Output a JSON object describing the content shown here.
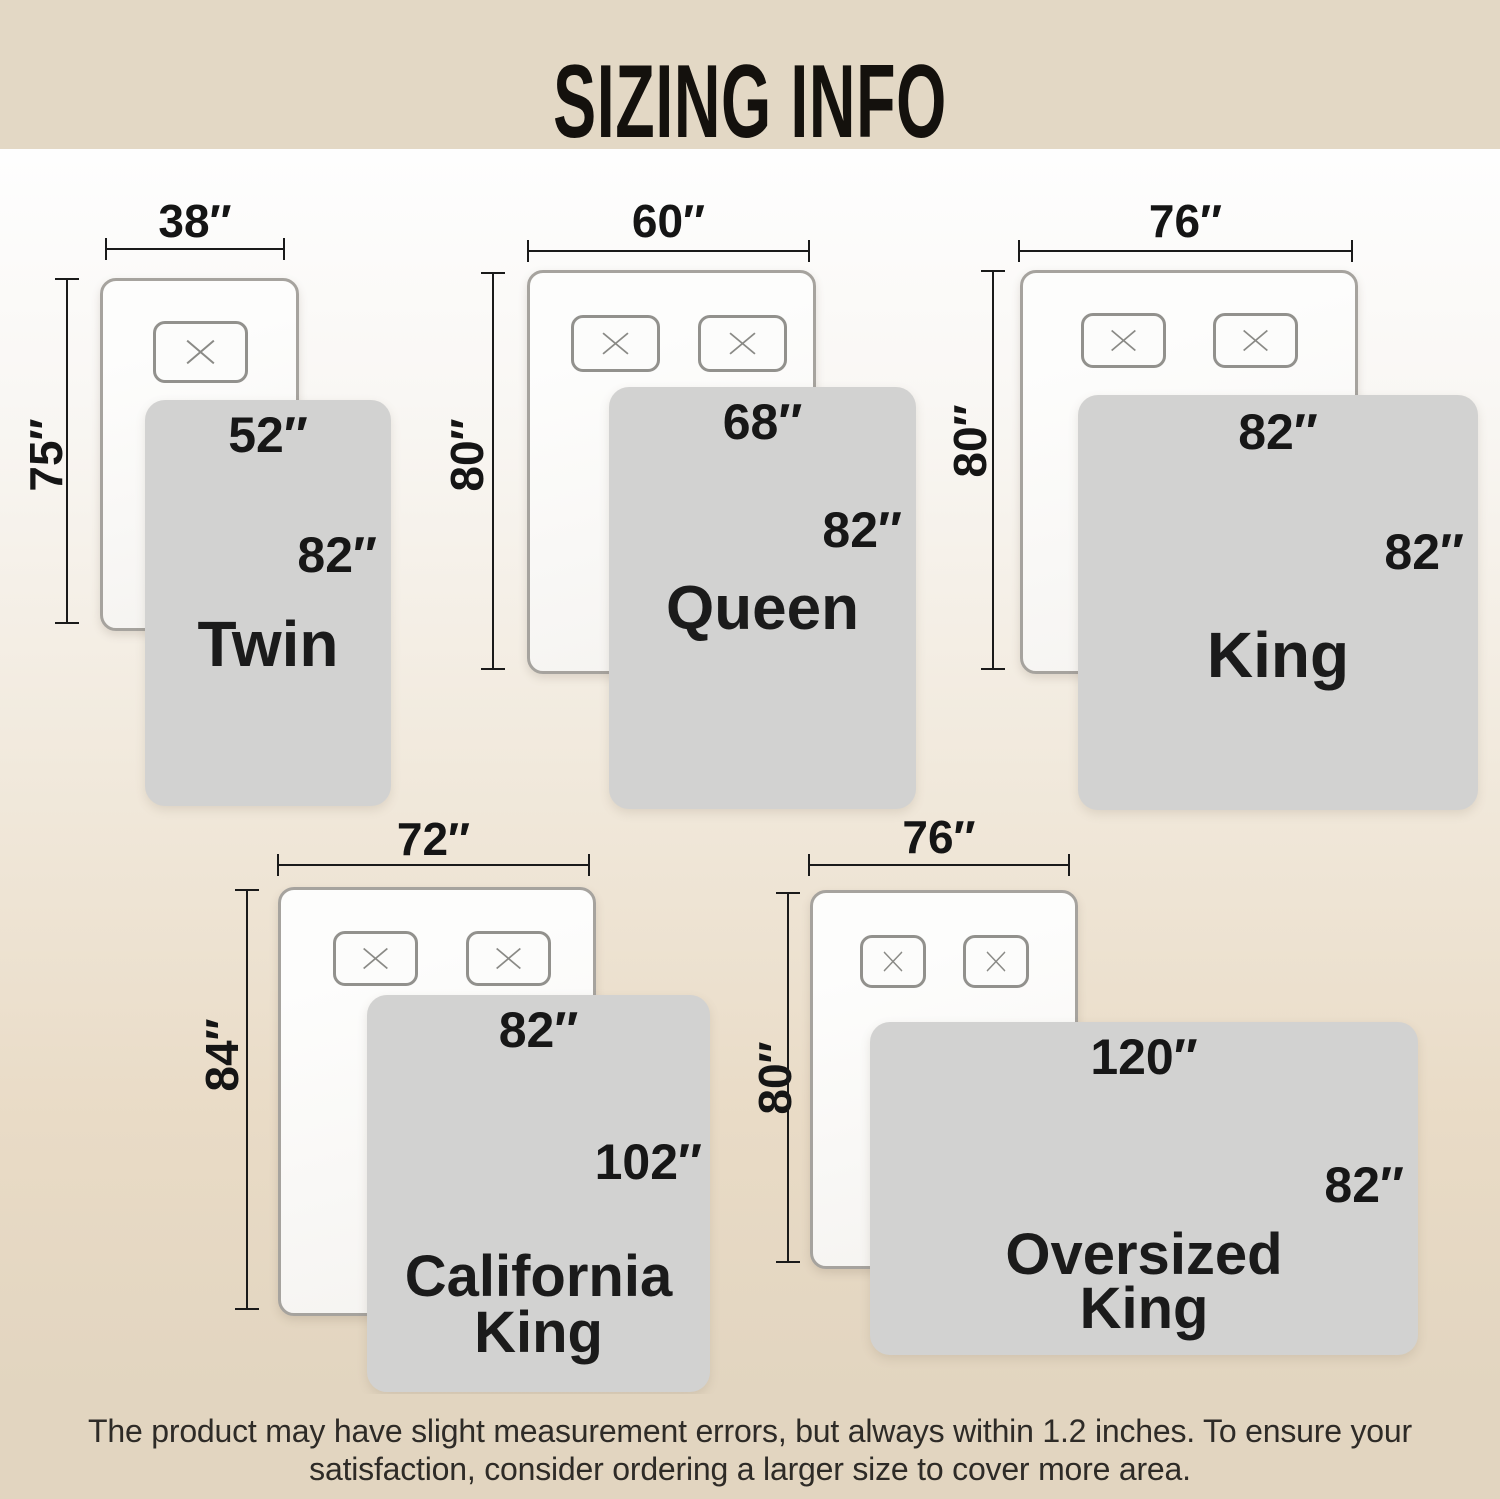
{
  "title": "SIZING INFO",
  "footer": {
    "line1": "The product may have slight measurement errors, but always within 1.2 inches. To ensure your",
    "line2": "satisfaction, consider ordering a larger size to cover more area."
  },
  "colors": {
    "banner_bg": "#e3d8c5",
    "footer_bg": "#e2d5c0",
    "board_gradient_top": "#fefefe",
    "board_gradient_bottom": "#e2d5c0",
    "blanket_fill": "#d2d2d1",
    "bed_fill": "#fcfcfb",
    "bed_border": "#a6a39e",
    "text": "#1b1b1b"
  },
  "sizes": [
    {
      "name": "Twin",
      "bed_width": "38″",
      "bed_length": "75″",
      "blanket_width": "52″",
      "blanket_length": "82″",
      "pillows": 1
    },
    {
      "name": "Queen",
      "bed_width": "60″",
      "bed_length": "80″",
      "blanket_width": "68″",
      "blanket_length": "82″",
      "pillows": 2
    },
    {
      "name": "King",
      "bed_width": "76″",
      "bed_length": "80″",
      "blanket_width": "82″",
      "blanket_length": "82″",
      "pillows": 2
    },
    {
      "name": "California King",
      "bed_width": "72″",
      "bed_length": "84″",
      "blanket_width": "82″",
      "blanket_length": "102″",
      "pillows": 2
    },
    {
      "name": "Oversized King",
      "bed_width": "76″",
      "bed_length": "80″",
      "blanket_width": "120″",
      "blanket_length": "82″",
      "pillows": 2
    }
  ]
}
